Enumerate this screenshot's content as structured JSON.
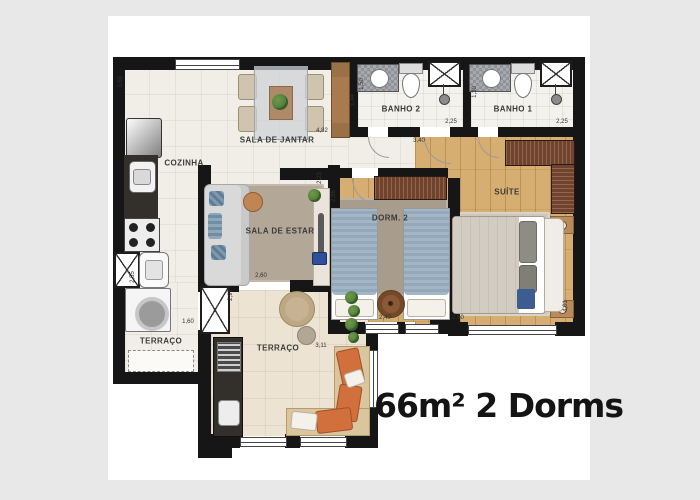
{
  "caption": "66m² 2 Dorms",
  "rooms": {
    "sala_de_jantar": "SALA DE JANTAR",
    "cozinha": "COZINHA",
    "banho_2": "BANHO 2",
    "banho_1": "BANHO 1",
    "sala_de_estar": "SALA DE ESTAR",
    "dorm_2": "DORM. 2",
    "suite": "SUÍTE",
    "terraco_servico": "TERRAÇO",
    "terraco": "TERRAÇO"
  },
  "dimensions": {
    "left_wall": "3,60",
    "dining_width": "4,82",
    "hall_cabinet": "1,44",
    "banho2_depth": "1,50",
    "banho2_width": "2,25",
    "banho1_depth": "1,30",
    "banho1_width": "2,25",
    "hall_width": "3,40",
    "living_depth": "2,96",
    "living_corner": "2,25",
    "living_opening": "2,60",
    "dorm2_width": "2,40",
    "suite_width": "2,60",
    "suite_depth": "4,01",
    "service_depth": "2,55",
    "service_width": "1,60",
    "terrace_depth": "2,97",
    "terrace_width": "3,11"
  },
  "colors": {
    "background": "#e8e8e8",
    "sheet": "#ffffff",
    "wall": "#161616",
    "tile": "#f1eee7",
    "terrace_tile": "#ece3d3",
    "wood": "#d7ae72",
    "dark_wood": "#6e4430",
    "rug": "#b3a797",
    "counter": "#33302c",
    "sofa": "#d9d9d9",
    "bed_blue": "#9fb2c4",
    "accent_orange": "#d2703d",
    "plant": "#4c7a36",
    "cabinet": "#a87a4e",
    "text": "#3a3a3a"
  }
}
